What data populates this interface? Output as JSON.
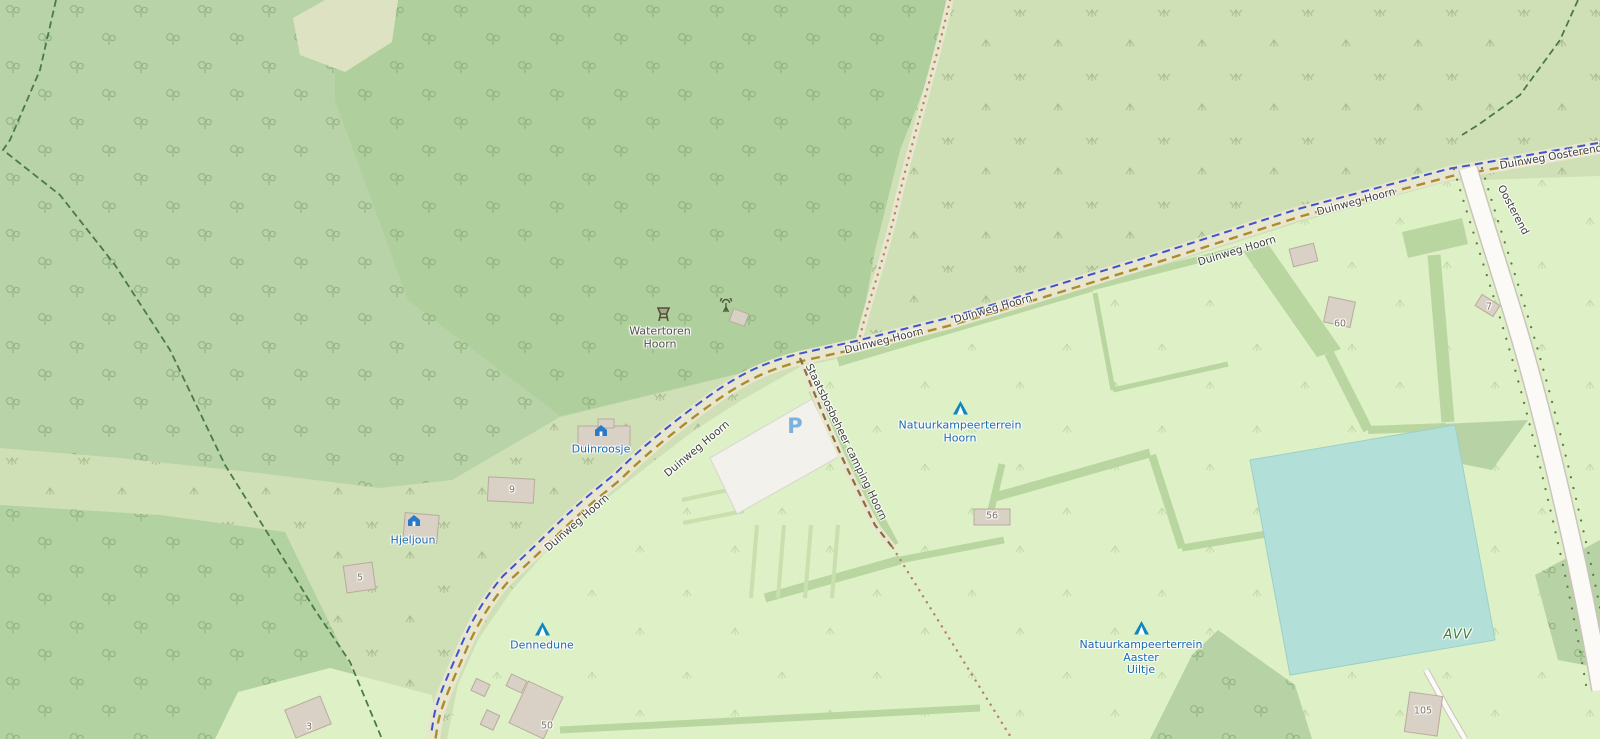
{
  "map": {
    "labels": {
      "watertoren_l1": "Watertoren",
      "watertoren_l2": "Hoorn",
      "duinroosje": "Duinroosje",
      "hjeljoun": "Hjeljoun",
      "dennedune": "Dennedune",
      "nk_hoorn_l1": "Natuurkampeerterrein",
      "nk_hoorn_l2": "Hoorn",
      "nk_aaster_l1": "Natuurkampeerterrein",
      "nk_aaster_l2": "Aaster",
      "nk_aaster_l3": "Uiltje",
      "avv": "AVV",
      "parking": "P"
    },
    "roads": {
      "duinweg_hoorn": "Duinweg Hoorn",
      "duinweg_oosterend": "Duinweg Oosterend",
      "staatsbosbeheer": "Staatsbosbeheer camping Hoorn",
      "oosterend": "Oosterend"
    },
    "housenumbers": {
      "h3": "3",
      "h5": "5",
      "h7": "7",
      "h9": "9",
      "h50": "50",
      "h56": "56",
      "h60": "60",
      "h105": "105"
    },
    "icons": {
      "campsite": "tent-triangle",
      "alpine_hut": "house-shape",
      "water_tower": "tower-shape",
      "communications_mast": "antenna-shape",
      "parking": "letter-P"
    },
    "colors": {
      "forest": "#b2d2a2",
      "heath": "#cfe0b7",
      "field": "#def0c6",
      "hedge": "#bad6a0",
      "water": "#b3dfd9",
      "building": "#d9d0c6",
      "road_white": "#fbfaf6",
      "cycleway_blue": "#3d55cc",
      "track_tan": "#ab8c2d",
      "boundary_green": "#4a7a45",
      "label_blue": "#1a6bb2",
      "label_green": "#3d7d2e"
    }
  }
}
